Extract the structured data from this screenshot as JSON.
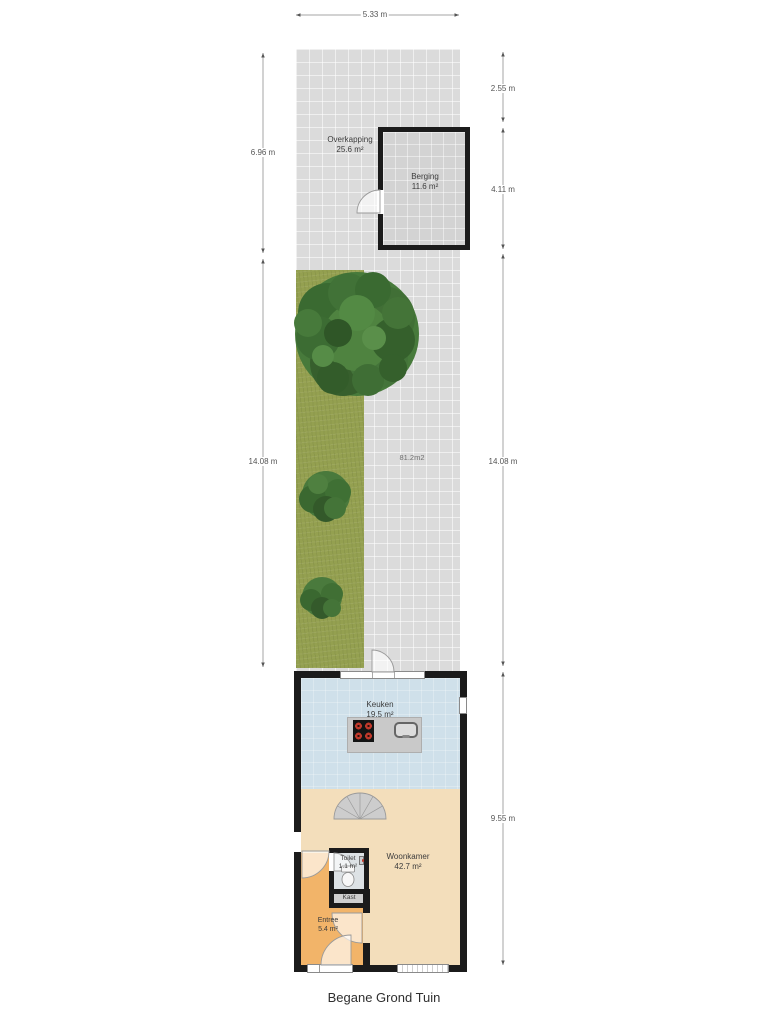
{
  "title": "Begane Grond Tuin",
  "dimensions": {
    "top_width": "5.33 m",
    "left_upper": "6.96 m",
    "left_garden": "14.08 m",
    "right_upper": "2.55 m",
    "right_berging": "4.11 m",
    "right_garden": "14.08 m",
    "right_house": "9.55 m"
  },
  "rooms": {
    "overkapping": {
      "name": "Overkapping",
      "area": "25.6 m²"
    },
    "berging": {
      "name": "Berging",
      "area": "11.6 m²"
    },
    "tuin": {
      "area": "81.2m2"
    },
    "keuken": {
      "name": "Keuken",
      "area": "19.5 m²"
    },
    "woonkamer": {
      "name": "Woonkamer",
      "area": "42.7 m²"
    },
    "toilet": {
      "name": "Toilet",
      "area": "1.1 m²"
    },
    "kast": {
      "name": "Kast"
    },
    "entree": {
      "name": "Entree",
      "area": "5.4 m²"
    }
  },
  "colors": {
    "paving": "#dbdbdb",
    "grass": "#94a050",
    "wall": "#1b1b1b",
    "kitchen_floor": "#cfe0ea",
    "living_floor": "#f3debb",
    "entree_floor": "#f2b469",
    "toilet_floor": "#dde2e5",
    "burner_red": "#c0392b"
  }
}
